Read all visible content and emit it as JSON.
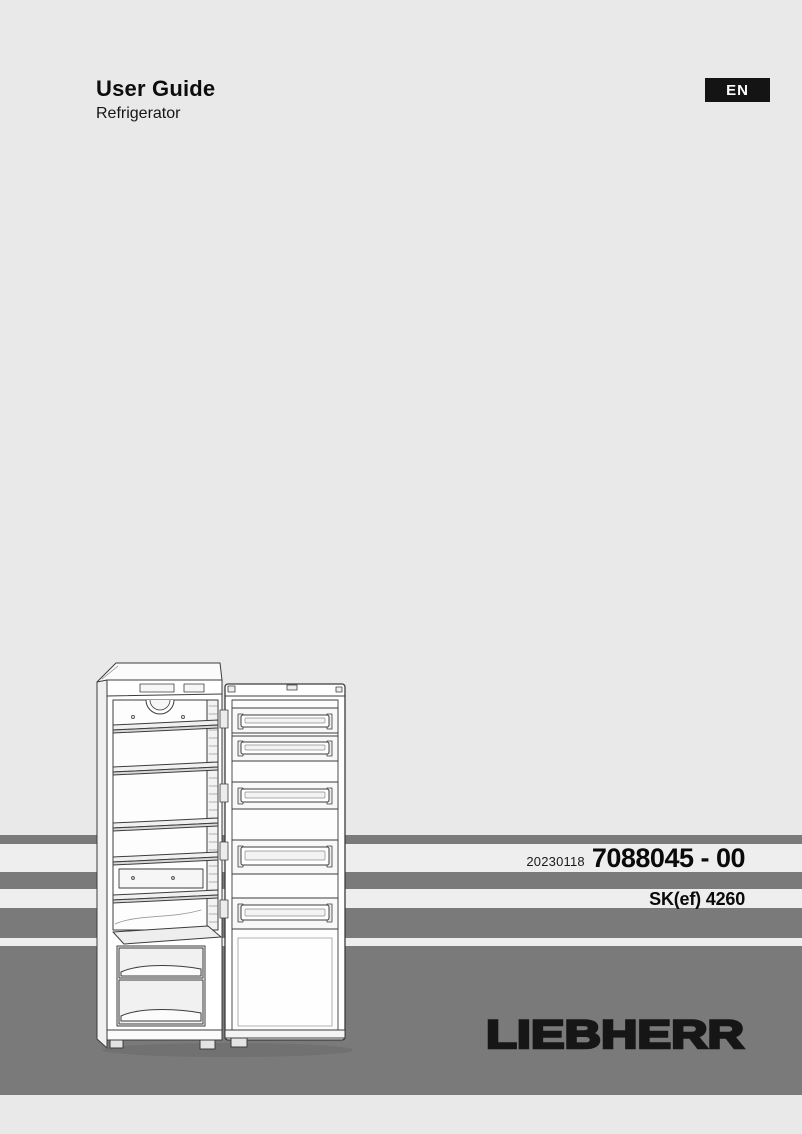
{
  "header": {
    "title": "User Guide",
    "subtitle": "Refrigerator",
    "language_badge": "EN"
  },
  "doc_info": {
    "date_code": "20230118",
    "document_number": "7088045 - 00",
    "model": "SK(ef) 4260"
  },
  "brand": {
    "logo_text": "LIEBHERR"
  },
  "illustration": {
    "description": "Line drawing of an upright refrigerator with open door, interior shelves, vegetable drawers and door bins"
  },
  "colors": {
    "page_bg": "#e9e9e9",
    "band_gray": "#7a7a7a",
    "band_light": "#eeeeee",
    "badge_bg": "#141414",
    "badge_text": "#ffffff",
    "text": "#111111"
  }
}
